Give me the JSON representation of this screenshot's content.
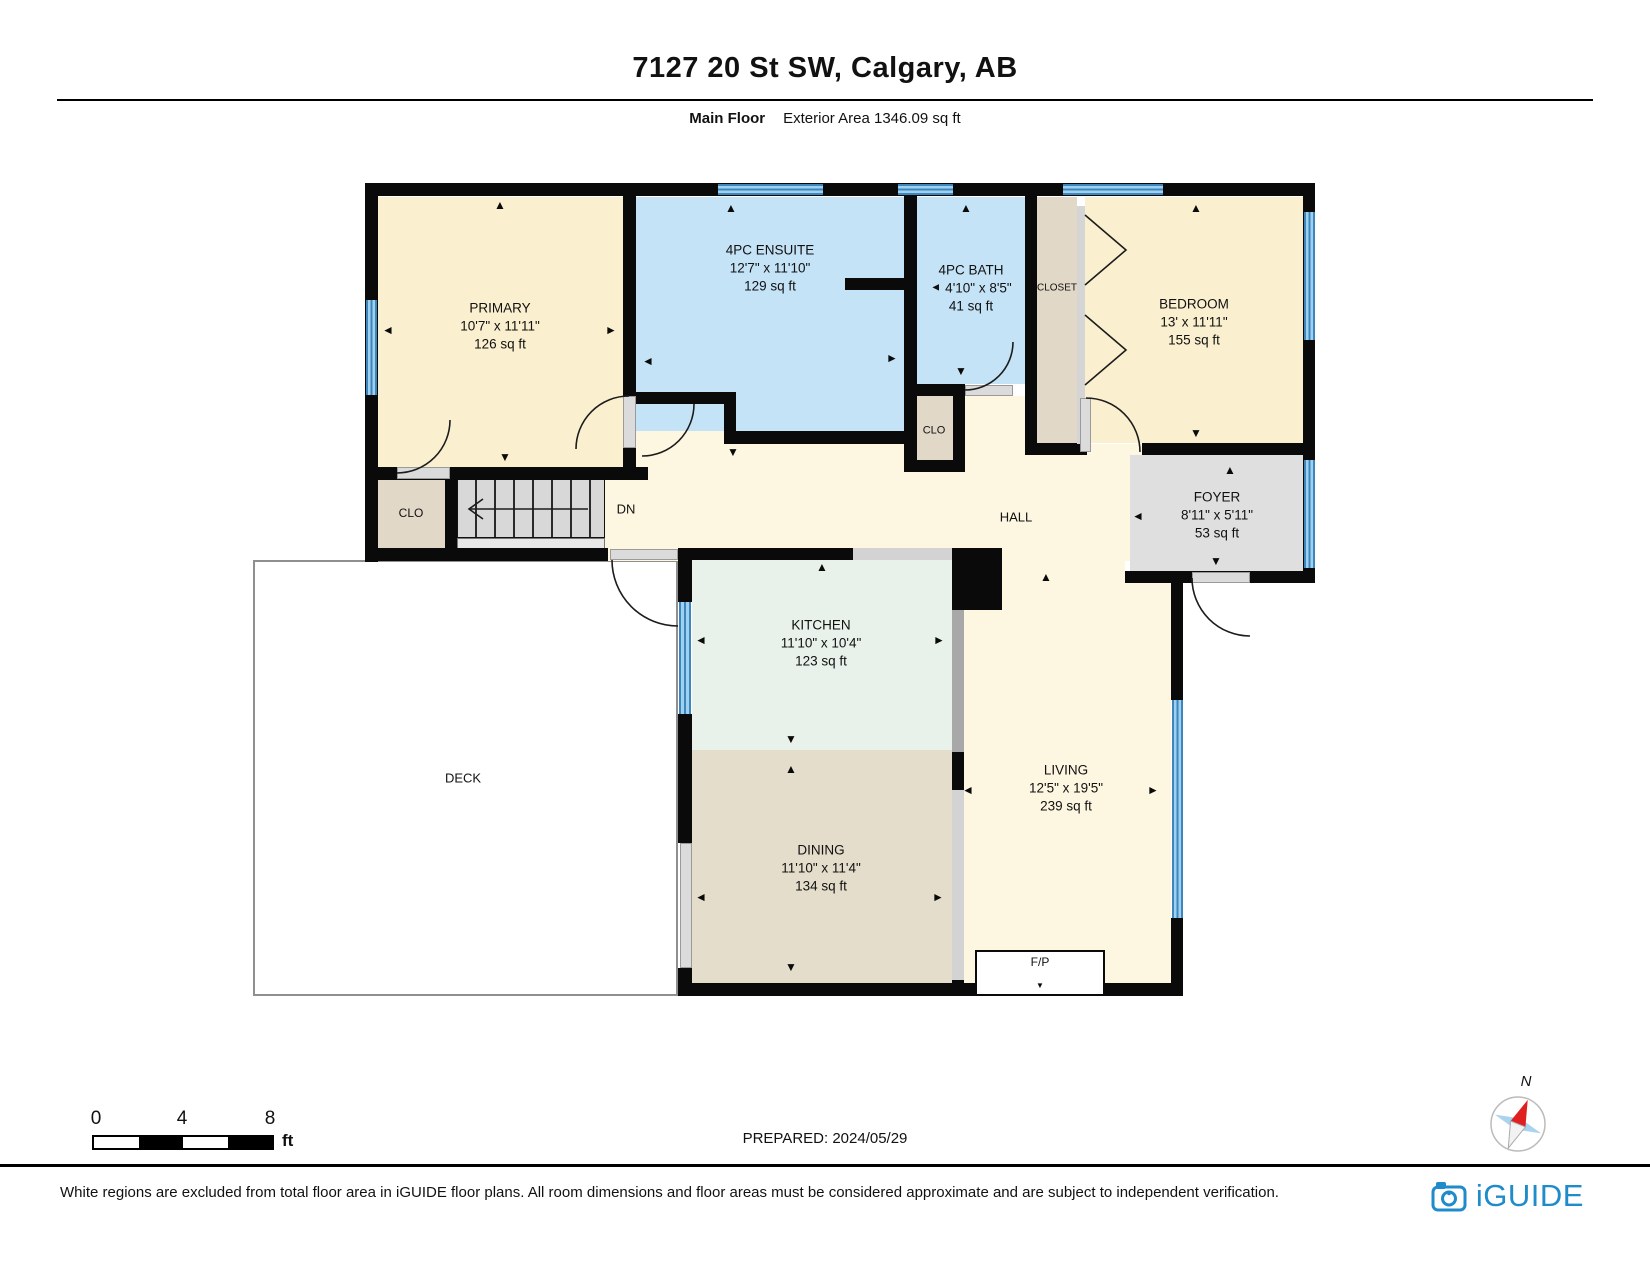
{
  "header": {
    "title": "7127 20 St SW, Calgary, AB",
    "floor_label": "Main Floor",
    "area_label": "Exterior Area 1346.09 sq ft"
  },
  "rooms": {
    "primary": {
      "name": "PRIMARY",
      "dims": "10'7\" x 11'11\"",
      "area": "126 sq ft"
    },
    "ensuite": {
      "name": "4PC ENSUITE",
      "dims": "12'7\" x 11'10\"",
      "area": "129 sq ft"
    },
    "bath": {
      "name": "4PC BATH",
      "dims": "4'10\" x 8'5\"",
      "area": "41 sq ft"
    },
    "closet": {
      "name": "CLOSET"
    },
    "bedroom": {
      "name": "BEDROOM",
      "dims": "13' x 11'11\"",
      "area": "155 sq ft"
    },
    "clo_bath": {
      "name": "CLO"
    },
    "clo_primary": {
      "name": "CLO"
    },
    "stairs": {
      "name": "DN"
    },
    "hall": {
      "name": "HALL"
    },
    "foyer": {
      "name": "FOYER",
      "dims": "8'11\" x 5'11\"",
      "area": "53 sq ft"
    },
    "kitchen": {
      "name": "KITCHEN",
      "dims": "11'10\" x 10'4\"",
      "area": "123 sq ft"
    },
    "deck": {
      "name": "DECK"
    },
    "dining": {
      "name": "DINING",
      "dims": "11'10\" x 11'4\"",
      "area": "134 sq ft"
    },
    "living": {
      "name": "LIVING",
      "dims": "12'5\" x 19'5\"",
      "area": "239 sq ft"
    },
    "fireplace": {
      "name": "F/P"
    }
  },
  "icons": {
    "up": "▲",
    "down": "▼",
    "left": "◄",
    "right": "►"
  },
  "scale_bar": {
    "tick0": "0",
    "tick1": "4",
    "tick2": "8",
    "unit": "ft"
  },
  "prepared": "PREPARED: 2024/05/29",
  "compass": {
    "label": "N"
  },
  "footer": {
    "disclaimer": "White regions are excluded from total floor area in iGUIDE floor plans. All room dimensions and floor areas must be considered approximate and are subject to independent verification.",
    "brand": "iGUIDE"
  },
  "colors": {
    "room_warm": "#FAEFCF",
    "room_hall": "#FDF6E1",
    "room_blue": "#C5E3F7",
    "room_tan": "#E2D8C8",
    "room_gray": "#DFDFDF",
    "room_mint": "#E8F1EA",
    "room_dining": "#E5DDCB",
    "wall": "#0A0A0A",
    "window": "#4D9FD6",
    "brand_blue": "#1F8BCB"
  }
}
